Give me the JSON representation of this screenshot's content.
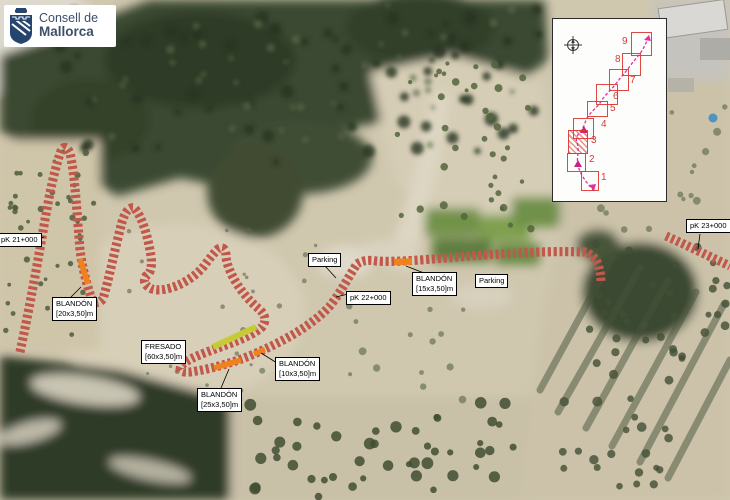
{
  "logo": {
    "line1": "Consell de",
    "line2": "Mallorca"
  },
  "map_labels": {
    "pk21": "pK 21+000",
    "pk22": "pK 22+000",
    "pk23": "pK 23+000",
    "parking1": "Parking",
    "parking2": "Parking",
    "blandon20": {
      "title": "BLANDÓN",
      "dims": "[20x3,50]m"
    },
    "fresado60": {
      "title": "FRESADO",
      "dims": "[60x3,50]m"
    },
    "blandon25": {
      "title": "BLANDÓN",
      "dims": "[25x3,50]m"
    },
    "blandon10": {
      "title": "BLANDÓN",
      "dims": "[10x3,50]m"
    },
    "blandon15": {
      "title": "BLANDÓN",
      "dims": "[15x3,50]m"
    }
  },
  "inset": {
    "current_sheet": "3",
    "sheets": [
      {
        "label": "1"
      },
      {
        "label": "2"
      },
      {
        "label": "3"
      },
      {
        "label": "4"
      },
      {
        "label": "5"
      },
      {
        "label": "6"
      },
      {
        "label": "7"
      },
      {
        "label": "8"
      },
      {
        "label": "9"
      }
    ]
  },
  "colors": {
    "blandon_orange": "#F0821E",
    "fresado_yellow": "#C6CB35",
    "sheet_red": "#DA3832",
    "route_magenta": "#E0309A",
    "road_edge": "#C2584B"
  }
}
